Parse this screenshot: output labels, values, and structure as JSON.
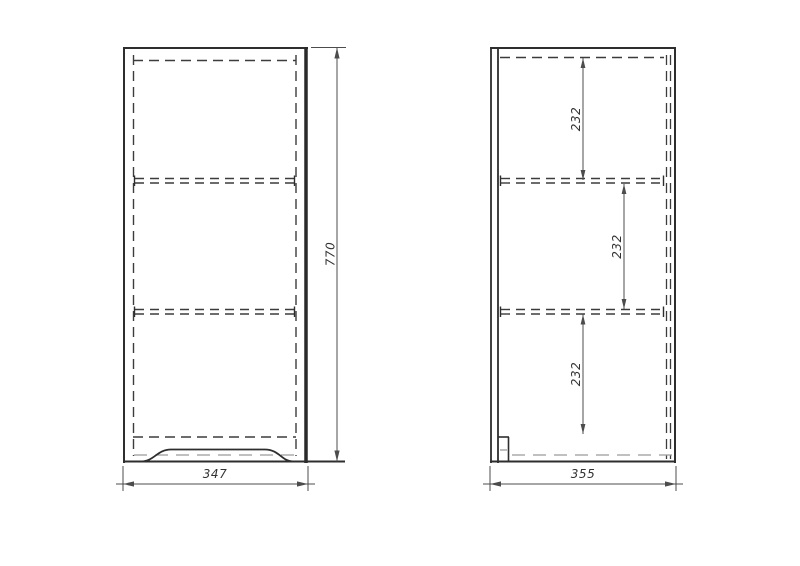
{
  "drawing": {
    "type": "cabinet-orthographic-technical-drawing",
    "dimensions": {
      "front_width": "347",
      "front_height": "770",
      "side_depth": "355",
      "side_sections": [
        "232",
        "232",
        "232"
      ]
    },
    "colors": {
      "background": "#ffffff",
      "visible_line": "#2e2e2e",
      "hidden_line": "#3c3c3c",
      "hidden_line_light": "#9a9a9a",
      "dimension_line": "#4c4c4c",
      "text": "#333333"
    }
  }
}
